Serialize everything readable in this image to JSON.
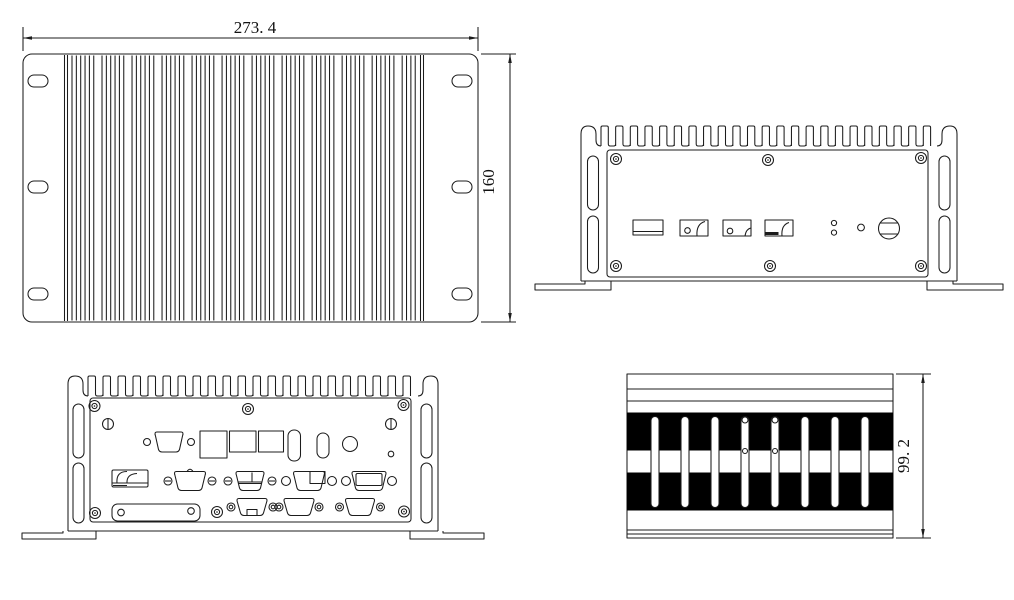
{
  "drawing": {
    "title": "fanless-box-pc-outline-drawing",
    "dimensions": {
      "top_width_mm": "273. 4",
      "top_depth_mm": "160",
      "side_height_mm": "99. 2"
    },
    "colors": {
      "line": "#1c1c1c",
      "background": "#ffffff",
      "band": "#000000"
    }
  }
}
